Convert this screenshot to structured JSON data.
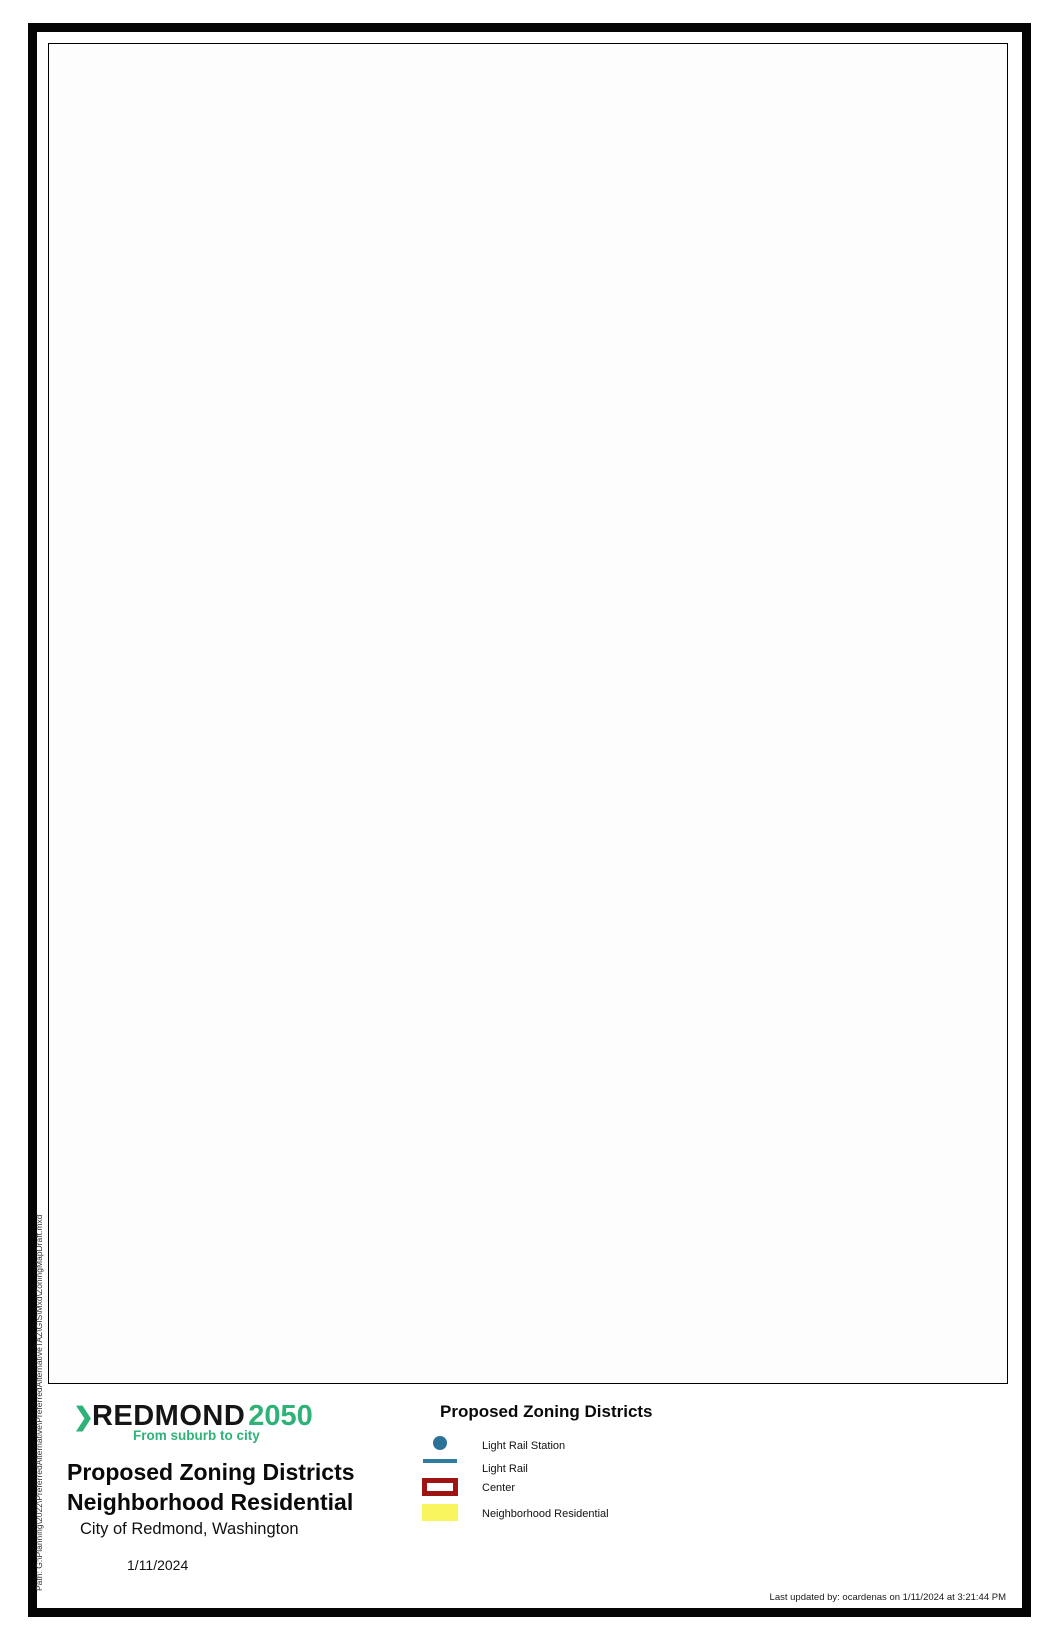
{
  "logo": {
    "chevron": "❯",
    "name": "REDMOND",
    "year": "2050",
    "tagline": "From suburb to city"
  },
  "titles": {
    "main_line1": "Proposed Zoning Districts",
    "main_line2": "Neighborhood Residential",
    "subtitle": "City of Redmond, Washington",
    "date": "1/11/2024"
  },
  "legend": {
    "header": "Proposed Zoning Districts",
    "items": [
      {
        "label": "Light Rail Station",
        "symbol": "station-dot",
        "color": "#2a7396"
      },
      {
        "label": "Light Rail",
        "symbol": "rail-line",
        "color": "#2e7da0"
      },
      {
        "label": "Center",
        "symbol": "center-outline",
        "color": "#9e1414"
      },
      {
        "label": "Neighborhood Residential",
        "symbol": "yellow-fill",
        "color": "#f8f55f"
      }
    ]
  },
  "map": {
    "scale_bar": {
      "start": "0",
      "mid": "0.5",
      "end": "1",
      "units": "Miles"
    },
    "north_label": "N"
  },
  "footer": {
    "last_updated": "Last updated by: ocardenas on 1/11/2024 at 3:21:44 PM",
    "path_label": "Path: G:\\Planning\\2022\\PreferredAlternative\\PreferredAlternativeTAZ\\GIS\\Mxd\\ZoningMapDraft.mxd"
  },
  "colors": {
    "neighborhood_residential": "#f2ee58",
    "center_outline": "#9e1414",
    "light_rail": "#2e7da0",
    "city_fill": "#ececec",
    "city_boundary": "#4d4d4d",
    "lake": "#c9c9ce",
    "park": "#dfe5db"
  }
}
